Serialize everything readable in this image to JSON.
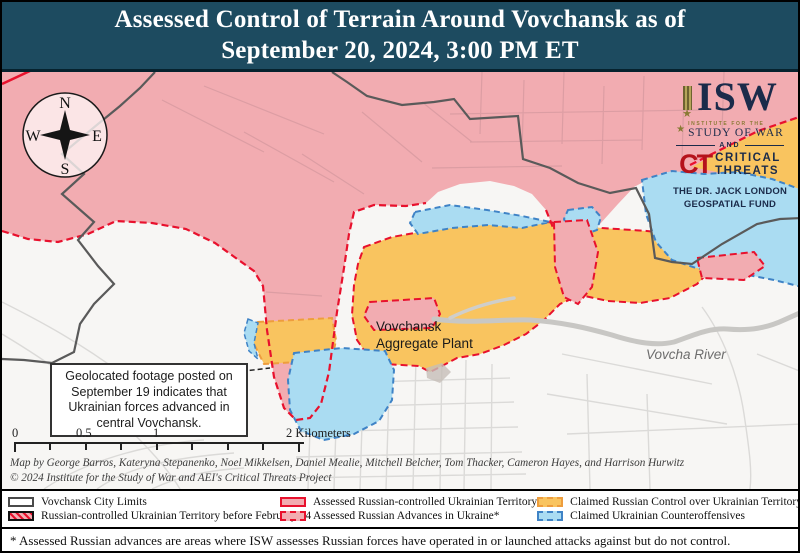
{
  "header": {
    "title_line1": "Assessed Control of Terrain Around Vovchansk as of",
    "title_line2": "September 20, 2024, 3:00 PM ET"
  },
  "logos": {
    "isw_acronym": "ISW",
    "isw_small_top": "INSTITUTE FOR THE",
    "isw_small_bottom": "STUDY OF WAR",
    "and_label": "AND",
    "ct_acronym": "CT",
    "ct_line1": "CRITICAL",
    "ct_line2": "THREATS",
    "fund_line1": "THE DR. JACK LONDON",
    "fund_line2": "GEOSPATIAL FUND"
  },
  "compass": {
    "n": "N",
    "e": "E",
    "s": "S",
    "w": "W"
  },
  "map": {
    "annotation": "Geolocated footage posted on September 19 indicates that Ukrainian forces advanced in central Vovchansk.",
    "labels": {
      "plant_line1": "Vovchansk",
      "plant_line2": "Aggregate Plant",
      "river": "Vovcha River"
    },
    "scale": {
      "tick0": "0",
      "tick05": "0.5",
      "tick1": "1",
      "tick2": "2 Kilometers"
    }
  },
  "credits": {
    "line1": "Map by George Barros, Kateryna Stepanenko, Noel Mikkelsen, Daniel Mealie, Mitchell Belcher, Tom Thacker, Cameron Hayes, and Harrison Hurwitz",
    "line2": "© 2024 Institute for the Study of War and AEI's Critical Threats Project"
  },
  "legend": {
    "items": [
      {
        "label": "Vovchansk City Limits"
      },
      {
        "label": "Russian-controlled Ukrainian Territory before February 24"
      },
      {
        "label": "Assessed Russian-controlled Ukrainian Territory"
      },
      {
        "label": "Assessed Russian Advances in Ukraine*"
      },
      {
        "label": "Claimed Russian Control over Ukrainian Territory"
      },
      {
        "label": "Claimed Ukrainian Counteroffensives"
      }
    ]
  },
  "footnote": "* Assessed Russian advances are areas where ISW assesses Russian forces have operated in or launched attacks against but do not control.",
  "colors": {
    "header_bg": "#1d4b60",
    "russian_controlled_fill": "#f2acb1",
    "russian_advance_border": "#e8112d",
    "claimed_russian_fill": "#f9c45f",
    "claimed_russian_border": "#ee9d3d",
    "claimed_ukrainian_fill": "#aadcf2",
    "claimed_ukrainian_border": "#3f83c6",
    "isw_navy": "#1b2b4a",
    "ct_red": "#b5121b"
  }
}
